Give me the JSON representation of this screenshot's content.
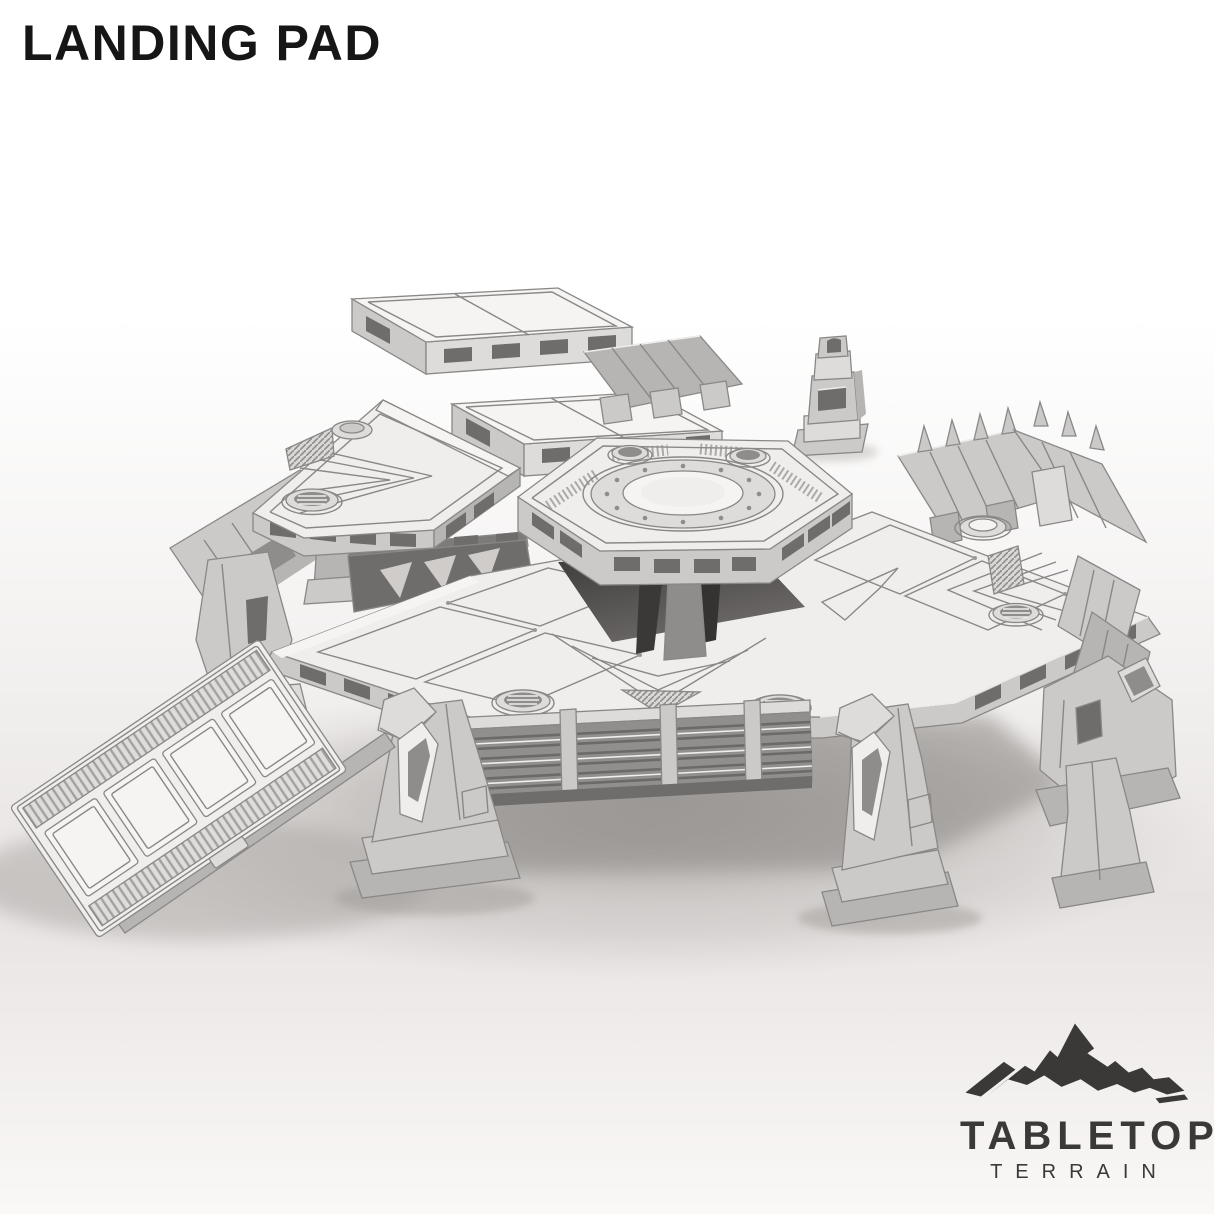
{
  "page": {
    "title": "LANDING PAD"
  },
  "logo": {
    "icon": "mountain-icon",
    "line1": "TABLETOP",
    "line2": "TERRAIN"
  },
  "product": {
    "subject": "landing-pad-terrain-model"
  },
  "palette": {
    "bg-top": "#ffffff",
    "bg-mid": "#f2f0ef",
    "bg-floor": "#e7e3e2",
    "bg-bottom": "#faf8f7",
    "ink": "#161616",
    "brand": "#3b3937",
    "m-white": "#f5f4f3",
    "m-top": "#efeeed",
    "m-mid": "#dddcdb",
    "m-side": "#cbcac9",
    "m-side2": "#b7b5b4",
    "m-dark": "#8f8d8b",
    "m-deep": "#6f6d6b",
    "m-line": "#8a8886",
    "shadow": "#a8a4a1"
  }
}
